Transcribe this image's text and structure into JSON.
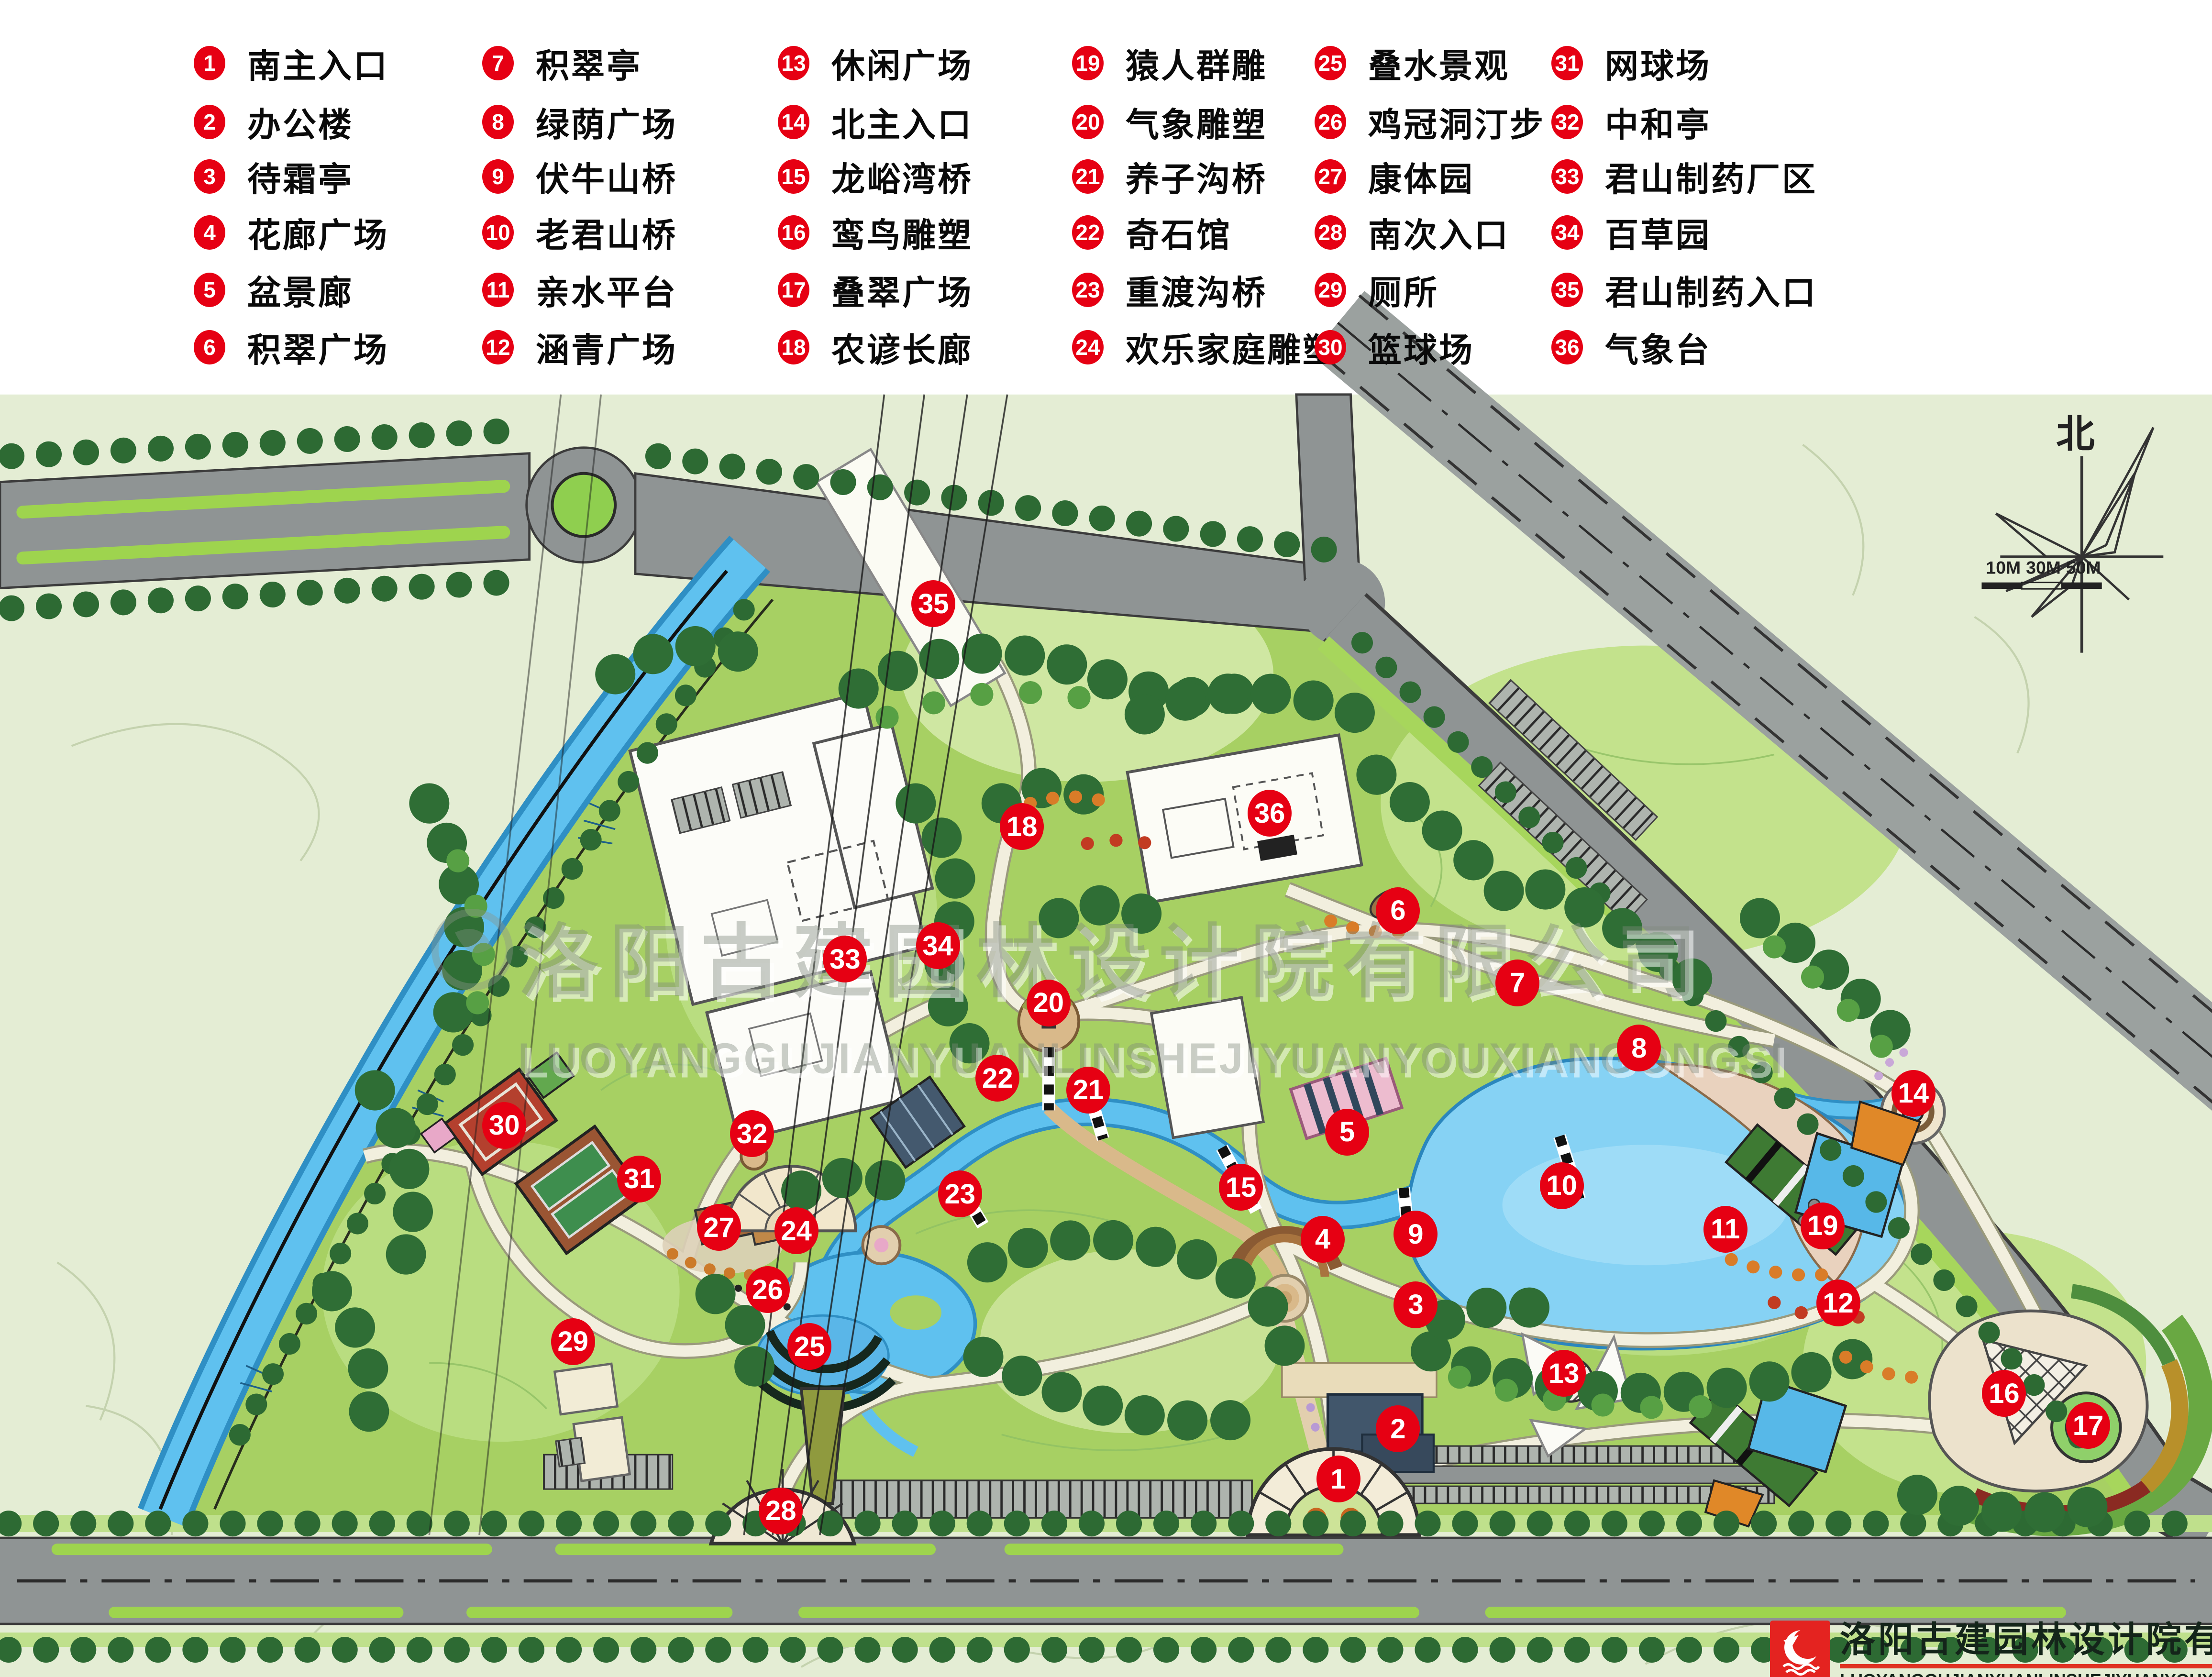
{
  "legend": {
    "items": [
      {
        "num": "1",
        "label": "南主入口"
      },
      {
        "num": "2",
        "label": "办公楼"
      },
      {
        "num": "3",
        "label": "待霜亭"
      },
      {
        "num": "4",
        "label": "花廊广场"
      },
      {
        "num": "5",
        "label": "盆景廊"
      },
      {
        "num": "6",
        "label": "积翠广场"
      },
      {
        "num": "7",
        "label": "积翠亭"
      },
      {
        "num": "8",
        "label": "绿荫广场"
      },
      {
        "num": "9",
        "label": "伏牛山桥"
      },
      {
        "num": "10",
        "label": "老君山桥"
      },
      {
        "num": "11",
        "label": "亲水平台"
      },
      {
        "num": "12",
        "label": "涵青广场"
      },
      {
        "num": "13",
        "label": "休闲广场"
      },
      {
        "num": "14",
        "label": "北主入口"
      },
      {
        "num": "15",
        "label": "龙峪湾桥"
      },
      {
        "num": "16",
        "label": "鸾鸟雕塑"
      },
      {
        "num": "17",
        "label": "叠翠广场"
      },
      {
        "num": "18",
        "label": "农谚长廊"
      },
      {
        "num": "19",
        "label": "猿人群雕"
      },
      {
        "num": "20",
        "label": "气象雕塑"
      },
      {
        "num": "21",
        "label": "养子沟桥"
      },
      {
        "num": "22",
        "label": "奇石馆"
      },
      {
        "num": "23",
        "label": "重渡沟桥"
      },
      {
        "num": "24",
        "label": "欢乐家庭雕塑"
      },
      {
        "num": "25",
        "label": "叠水景观"
      },
      {
        "num": "26",
        "label": "鸡冠洞汀步"
      },
      {
        "num": "27",
        "label": "康体园"
      },
      {
        "num": "28",
        "label": "南次入口"
      },
      {
        "num": "29",
        "label": "厕所"
      },
      {
        "num": "30",
        "label": "篮球场"
      },
      {
        "num": "31",
        "label": "网球场"
      },
      {
        "num": "32",
        "label": "中和亭"
      },
      {
        "num": "33",
        "label": "君山制药厂区"
      },
      {
        "num": "34",
        "label": "百草园"
      },
      {
        "num": "35",
        "label": "君山制药入口"
      },
      {
        "num": "36",
        "label": "气象台"
      }
    ]
  },
  "markers": [
    {
      "num": "1",
      "x": 60.5,
      "y": 88.2
    },
    {
      "num": "2",
      "x": 63.2,
      "y": 85.2
    },
    {
      "num": "3",
      "x": 64.0,
      "y": 77.8
    },
    {
      "num": "4",
      "x": 59.8,
      "y": 73.9
    },
    {
      "num": "5",
      "x": 60.9,
      "y": 67.5
    },
    {
      "num": "6",
      "x": 63.2,
      "y": 54.3
    },
    {
      "num": "7",
      "x": 68.6,
      "y": 58.6
    },
    {
      "num": "8",
      "x": 74.1,
      "y": 62.5
    },
    {
      "num": "9",
      "x": 64.0,
      "y": 73.6
    },
    {
      "num": "10",
      "x": 70.6,
      "y": 70.7
    },
    {
      "num": "11",
      "x": 78.0,
      "y": 73.3
    },
    {
      "num": "12",
      "x": 83.1,
      "y": 77.7
    },
    {
      "num": "13",
      "x": 70.7,
      "y": 81.9
    },
    {
      "num": "14",
      "x": 86.5,
      "y": 65.2
    },
    {
      "num": "15",
      "x": 56.1,
      "y": 70.8
    },
    {
      "num": "16",
      "x": 90.6,
      "y": 83.1
    },
    {
      "num": "17",
      "x": 94.4,
      "y": 85.0
    },
    {
      "num": "18",
      "x": 46.2,
      "y": 49.3
    },
    {
      "num": "19",
      "x": 82.4,
      "y": 73.1
    },
    {
      "num": "20",
      "x": 47.4,
      "y": 59.8
    },
    {
      "num": "21",
      "x": 49.2,
      "y": 65.0
    },
    {
      "num": "22",
      "x": 45.1,
      "y": 64.3
    },
    {
      "num": "23",
      "x": 43.4,
      "y": 71.2
    },
    {
      "num": "24",
      "x": 36.0,
      "y": 73.4
    },
    {
      "num": "25",
      "x": 36.6,
      "y": 80.3
    },
    {
      "num": "26",
      "x": 34.7,
      "y": 76.9
    },
    {
      "num": "27",
      "x": 32.5,
      "y": 73.2
    },
    {
      "num": "28",
      "x": 35.3,
      "y": 90.1
    },
    {
      "num": "29",
      "x": 25.9,
      "y": 80.0
    },
    {
      "num": "30",
      "x": 22.8,
      "y": 67.1
    },
    {
      "num": "31",
      "x": 28.9,
      "y": 70.3
    },
    {
      "num": "32",
      "x": 34.0,
      "y": 67.6
    },
    {
      "num": "33",
      "x": 38.2,
      "y": 57.2
    },
    {
      "num": "34",
      "x": 42.4,
      "y": 56.4
    },
    {
      "num": "35",
      "x": 42.2,
      "y": 36.0
    },
    {
      "num": "36",
      "x": 57.4,
      "y": 48.5
    }
  ],
  "compass": {
    "north_label": "北"
  },
  "scalebar": {
    "labels": [
      "10M",
      "30M",
      "50M"
    ]
  },
  "watermark": {
    "cn": "洛阳古建园林设计院有限公司",
    "en": "LUOYANGGUJIANYUANLINSHEJIYUANYOUXIANGONGSI"
  },
  "brand": {
    "company_cn": "洛阳古建园林设计院有限公司",
    "company_en": "LUOYANGGUJIANYUANLINSHEJIYUANYOUXIANGONGSI"
  },
  "colors": {
    "marker_red": "#e60013",
    "park_green": "#a7d063",
    "water_blue": "#5fc1ef",
    "road_gray": "#8f9494",
    "outer_land": "#e4edd4",
    "path_cream": "#f2efde"
  }
}
